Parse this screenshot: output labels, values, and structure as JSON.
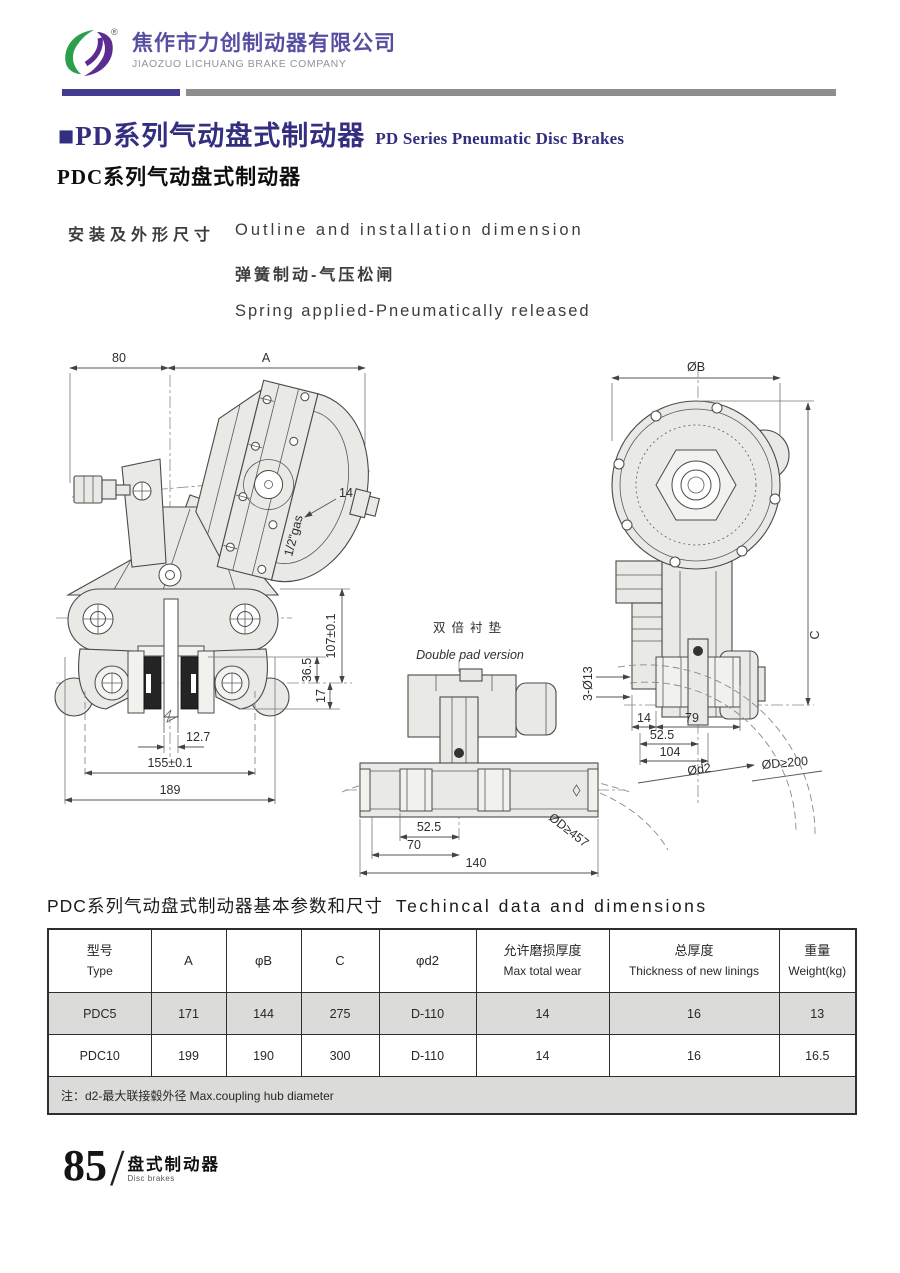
{
  "header": {
    "company_cn": "焦作市力创制动器有限公司",
    "company_en": "JIAOZUO LICHUANG BRAKE COMPANY",
    "registered": "®"
  },
  "title": {
    "main_cn": "■PD系列气动盘式制动器",
    "main_en": "PD Series Pneumatic Disc Brakes",
    "sub": "PDC系列气动盘式制动器"
  },
  "intro": {
    "install_cn": "安装及外形尺寸",
    "install_en": "Outline and installation dimension",
    "spring_cn": "弹簧制动-气压松闸",
    "spring_en": "Spring applied-Pneumatically released"
  },
  "drawings": {
    "front_view": {
      "dims": {
        "d80": "80",
        "dA": "A",
        "d14": "14",
        "gas": "1/2\"gas",
        "d107": "107±0.1",
        "d36_5": "36.5",
        "d17": "17",
        "d12_7": "12.7",
        "d155": "155±0.1",
        "d189": "189"
      }
    },
    "double_pad_view": {
      "title_cn": "双倍衬垫",
      "title_en": "Double pad version",
      "dims": {
        "d52_5": "52.5",
        "d70": "70",
        "d140": "140",
        "dD457": "ØD≥457"
      }
    },
    "side_view": {
      "dims": {
        "dB": "ØB",
        "dC": "C",
        "d3x13": "3-Ø13",
        "d14": "14",
        "d79": "79",
        "d52_5": "52.5",
        "d104": "104",
        "dd2": "Ød2",
        "dD200": "ØD≥200"
      }
    }
  },
  "table": {
    "title_cn": "PDC系列气动盘式制动器基本参数和尺寸",
    "title_en": "Techincal data and dimensions",
    "headers": [
      {
        "cn": "型号",
        "en": "Type"
      },
      {
        "cn": "A",
        "en": ""
      },
      {
        "cn": "φB",
        "en": ""
      },
      {
        "cn": "C",
        "en": ""
      },
      {
        "cn": "φd2",
        "en": ""
      },
      {
        "cn": "允许磨损厚度",
        "en": "Max total wear"
      },
      {
        "cn": "总厚度",
        "en": "Thickness of new linings"
      },
      {
        "cn": "重量",
        "en": "Weight(kg)"
      }
    ],
    "rows": [
      [
        "PDC5",
        "171",
        "144",
        "275",
        "D-110",
        "14",
        "16",
        "13"
      ],
      [
        "PDC10",
        "199",
        "190",
        "300",
        "D-110",
        "14",
        "16",
        "16.5"
      ]
    ],
    "note": "注：d2-最大联接毂外径  Max.coupling hub diameter"
  },
  "footer": {
    "page": "85",
    "slash": "/",
    "section_cn": "盘式制动器",
    "section_en": "Disc brakes"
  },
  "colors": {
    "accent_purple": "#332e80",
    "logo_green": "#2aa04d",
    "logo_purple": "#5b2d91",
    "divider_gray": "#8e8e90",
    "table_row_gray": "#dbdbda"
  }
}
